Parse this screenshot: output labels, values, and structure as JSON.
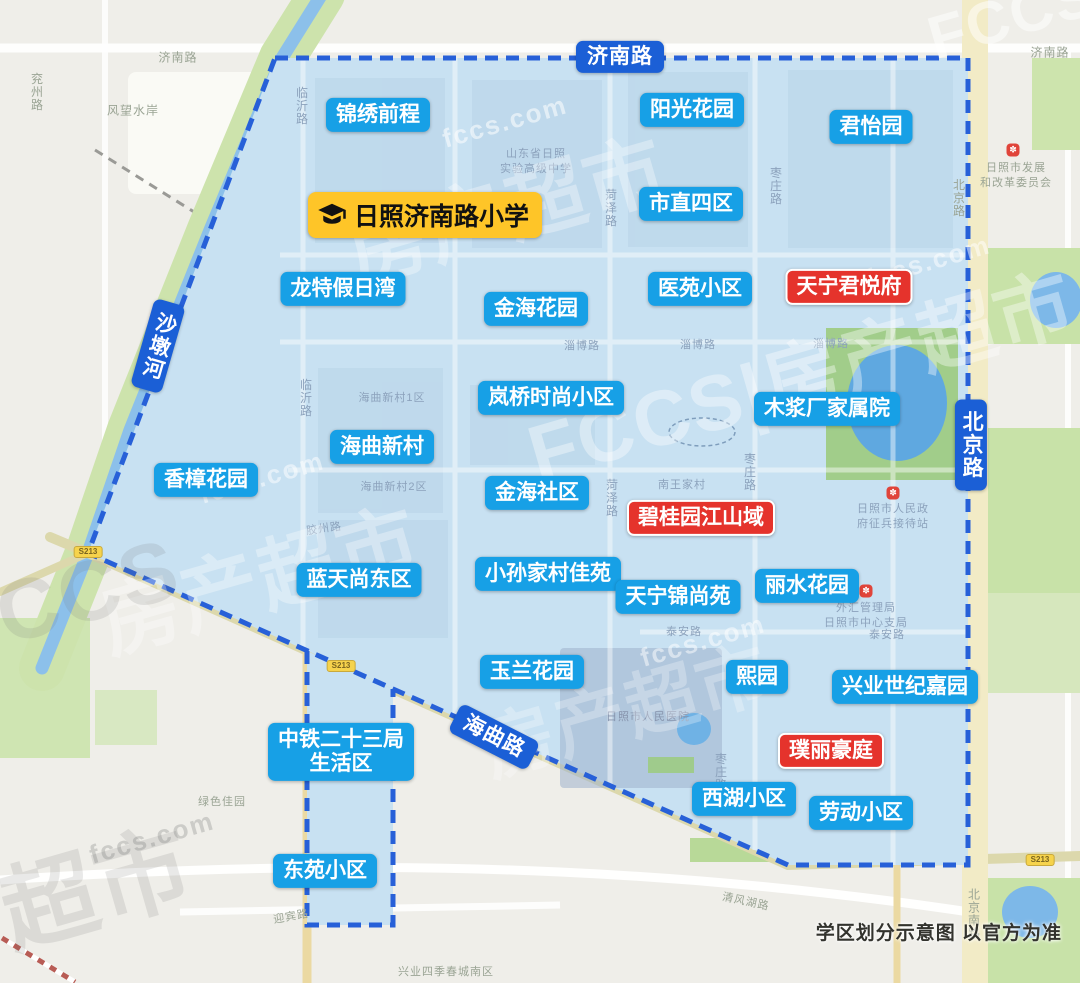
{
  "map": {
    "disclaimer": "学区划分示意图  以官方为准",
    "school": {
      "label": "日照济南路小学",
      "x": 425,
      "y": 215,
      "icon": "graduation-cap-icon"
    },
    "colors": {
      "district_fill": "#c8e1f2",
      "boundary_blue": "#2760d8",
      "community_badge_blue": "#17a0e6",
      "highlight_badge_red": "#e5332c",
      "road_badge_blue": "#1b5fd6",
      "school_badge_yellow": "#fec528",
      "map_label_gray": "#9aa494",
      "map_label_blue": "#8ca2bc",
      "map_label_dark": "#8794ad"
    },
    "road_badges": [
      {
        "label": "济南路",
        "x": 620,
        "y": 57,
        "orient": "h",
        "rot": 0
      },
      {
        "label": "北京路",
        "x": 971,
        "y": 445,
        "orient": "v",
        "rot": 0
      },
      {
        "label": "海曲路",
        "x": 494,
        "y": 737,
        "orient": "h",
        "rot": 27
      },
      {
        "label": "沙墩河",
        "x": 158,
        "y": 346,
        "orient": "v",
        "rot": 16
      }
    ],
    "communities_blue": [
      {
        "label": "锦绣前程",
        "x": 378,
        "y": 115
      },
      {
        "label": "阳光花园",
        "x": 692,
        "y": 110
      },
      {
        "label": "君怡园",
        "x": 871,
        "y": 127
      },
      {
        "label": "市直四区",
        "x": 691,
        "y": 204
      },
      {
        "label": "龙特假日湾",
        "x": 343,
        "y": 289
      },
      {
        "label": "金海花园",
        "x": 536,
        "y": 309
      },
      {
        "label": "医苑小区",
        "x": 700,
        "y": 289
      },
      {
        "label": "岚桥时尚小区",
        "x": 551,
        "y": 398
      },
      {
        "label": "木浆厂家属院",
        "x": 827,
        "y": 409
      },
      {
        "label": "海曲新村",
        "x": 382,
        "y": 447
      },
      {
        "label": "香樟花园",
        "x": 206,
        "y": 480
      },
      {
        "label": "金海社区",
        "x": 537,
        "y": 493
      },
      {
        "label": "蓝天尚东区",
        "x": 359,
        "y": 580
      },
      {
        "label": "小孙家村佳苑",
        "x": 548,
        "y": 574
      },
      {
        "label": "天宁锦尚苑",
        "x": 678,
        "y": 597
      },
      {
        "label": "丽水花园",
        "x": 807,
        "y": 586
      },
      {
        "label": "玉兰花园",
        "x": 532,
        "y": 672
      },
      {
        "label": "熙园",
        "x": 757,
        "y": 677
      },
      {
        "label": "兴业世纪嘉园",
        "x": 905,
        "y": 687
      },
      {
        "label": "中铁二十三局\n生活区",
        "x": 341,
        "y": 752
      },
      {
        "label": "西湖小区",
        "x": 744,
        "y": 799
      },
      {
        "label": "劳动小区",
        "x": 861,
        "y": 813
      },
      {
        "label": "东苑小区",
        "x": 325,
        "y": 871
      }
    ],
    "communities_red": [
      {
        "label": "天宁君悦府",
        "x": 849,
        "y": 287
      },
      {
        "label": "碧桂园江山域",
        "x": 701,
        "y": 518
      },
      {
        "label": "璞丽豪庭",
        "x": 831,
        "y": 751
      }
    ],
    "map_labels": [
      {
        "text": "济南路",
        "x": 178,
        "y": 57,
        "o": "h",
        "c": "gray"
      },
      {
        "text": "济南路",
        "x": 1050,
        "y": 52,
        "o": "h",
        "c": "gray"
      },
      {
        "text": "兖州路",
        "x": 37,
        "y": 92,
        "o": "v",
        "c": "gray"
      },
      {
        "text": "风望水岸",
        "x": 133,
        "y": 110,
        "o": "h",
        "c": "gray"
      },
      {
        "text": "临沂路",
        "x": 302,
        "y": 106,
        "o": "v",
        "c": "blue"
      },
      {
        "text": "临沂路",
        "x": 306,
        "y": 398,
        "o": "v",
        "c": "blue"
      },
      {
        "text": "菏泽路",
        "x": 611,
        "y": 208,
        "o": "v",
        "c": "blue"
      },
      {
        "text": "菏泽路",
        "x": 612,
        "y": 498,
        "o": "v",
        "c": "blue"
      },
      {
        "text": "枣庄路",
        "x": 776,
        "y": 186,
        "o": "v",
        "c": "blue"
      },
      {
        "text": "枣庄路",
        "x": 750,
        "y": 472,
        "o": "v",
        "c": "blue"
      },
      {
        "text": "枣庄路",
        "x": 721,
        "y": 772,
        "o": "v",
        "c": "blue"
      },
      {
        "text": "淄博路",
        "x": 582,
        "y": 345,
        "o": "h",
        "c": "blue",
        "small": true
      },
      {
        "text": "淄博路",
        "x": 698,
        "y": 344,
        "o": "h",
        "c": "blue",
        "small": true
      },
      {
        "text": "淄博路",
        "x": 831,
        "y": 343,
        "o": "h",
        "c": "blue",
        "small": true
      },
      {
        "text": "泰安路",
        "x": 684,
        "y": 631,
        "o": "h",
        "c": "blue",
        "small": true
      },
      {
        "text": "泰安路",
        "x": 887,
        "y": 634,
        "o": "h",
        "c": "blue",
        "small": true
      },
      {
        "text": "海曲新村1区",
        "x": 392,
        "y": 397,
        "o": "h",
        "c": "blue",
        "small": true
      },
      {
        "text": "海曲新村2区",
        "x": 394,
        "y": 486,
        "o": "h",
        "c": "blue",
        "small": true
      },
      {
        "text": "南王家村",
        "x": 682,
        "y": 484,
        "o": "h",
        "c": "blue",
        "small": true
      },
      {
        "text": "胶州路",
        "x": 324,
        "y": 528,
        "o": "h",
        "c": "blue",
        "small": true,
        "rot": -8
      },
      {
        "text": "山东省日照",
        "x": 536,
        "y": 153,
        "o": "h",
        "c": "blue",
        "small": true
      },
      {
        "text": "实验高级中学",
        "x": 536,
        "y": 168,
        "o": "h",
        "c": "blue",
        "small": true
      },
      {
        "text": "日照市发展",
        "x": 1016,
        "y": 167,
        "o": "h",
        "c": "gray",
        "small": true
      },
      {
        "text": "和改革委员会",
        "x": 1016,
        "y": 182,
        "o": "h",
        "c": "gray",
        "small": true
      },
      {
        "text": "日照市人民政",
        "x": 893,
        "y": 508,
        "o": "h",
        "c": "blue",
        "small": true
      },
      {
        "text": "府征兵接待站",
        "x": 893,
        "y": 523,
        "o": "h",
        "c": "blue",
        "small": true
      },
      {
        "text": "外汇管理局",
        "x": 866,
        "y": 607,
        "o": "h",
        "c": "blue",
        "small": true
      },
      {
        "text": "日照市中心支局",
        "x": 866,
        "y": 622,
        "o": "h",
        "c": "blue",
        "small": true
      },
      {
        "text": "日照市人民医院",
        "x": 648,
        "y": 716,
        "o": "h",
        "c": "dark",
        "small": true
      },
      {
        "text": "绿色佳园",
        "x": 222,
        "y": 801,
        "o": "h",
        "c": "gray",
        "small": true
      },
      {
        "text": "兴业四季春城南区",
        "x": 446,
        "y": 971,
        "o": "h",
        "c": "gray",
        "small": true
      },
      {
        "text": "迎宾路",
        "x": 291,
        "y": 916,
        "o": "h",
        "c": "gray",
        "small": true,
        "rot": -10
      },
      {
        "text": "清风湖路",
        "x": 746,
        "y": 901,
        "o": "h",
        "c": "gray",
        "small": true,
        "rot": 12
      },
      {
        "text": "北京南路",
        "x": 974,
        "y": 914,
        "o": "v",
        "c": "gray"
      },
      {
        "text": "北京路",
        "x": 959,
        "y": 198,
        "o": "v",
        "c": "gray"
      }
    ],
    "pois": [
      {
        "x": 1013,
        "y": 150
      },
      {
        "x": 893,
        "y": 493
      },
      {
        "x": 866,
        "y": 591
      }
    ],
    "road_shields": [
      {
        "text": "S213",
        "x": 88,
        "y": 552
      },
      {
        "text": "S213",
        "x": 341,
        "y": 666
      },
      {
        "text": "S213",
        "x": 1040,
        "y": 860
      }
    ],
    "watermarks": [
      {
        "text": "fccs.com",
        "x": 505,
        "y": 122,
        "size": 26,
        "rot": -16,
        "color": "rgba(255,255,255,0.55)"
      },
      {
        "text": "fccs.com",
        "x": 928,
        "y": 262,
        "size": 26,
        "rot": -16,
        "color": "rgba(255,255,255,0.5)"
      },
      {
        "text": "fccs.com",
        "x": 262,
        "y": 478,
        "size": 26,
        "rot": -16,
        "color": "rgba(255,255,255,0.5)"
      },
      {
        "text": "fccs.com",
        "x": 703,
        "y": 641,
        "size": 26,
        "rot": -16,
        "color": "rgba(255,255,255,0.5)"
      },
      {
        "text": "fccs.com",
        "x": 152,
        "y": 838,
        "size": 26,
        "rot": -16,
        "color": "rgba(140,140,140,0.35)"
      },
      {
        "text": "FCCS|房产超市",
        "x": 800,
        "y": 372,
        "size": 78,
        "rot": -16,
        "color": "rgba(255,255,255,0.38)"
      },
      {
        "text": "房产超市",
        "x": 505,
        "y": 205,
        "size": 80,
        "rot": -16,
        "color": "rgba(255,255,255,0.33)"
      },
      {
        "text": "房产超市",
        "x": 258,
        "y": 575,
        "size": 80,
        "rot": -16,
        "color": "rgba(255,255,255,0.33)"
      },
      {
        "text": "房产超市",
        "x": 625,
        "y": 705,
        "size": 72,
        "rot": -16,
        "color": "rgba(255,255,255,0.28)"
      },
      {
        "text": "FCCS",
        "x": 62,
        "y": 600,
        "size": 85,
        "rot": -16,
        "color": "rgba(120,120,120,0.16)"
      },
      {
        "text": "超市",
        "x": 95,
        "y": 882,
        "size": 95,
        "rot": -16,
        "color": "rgba(110,110,110,0.15)"
      },
      {
        "text": "FCCS",
        "x": 1012,
        "y": 16,
        "size": 60,
        "rot": -16,
        "color": "rgba(255,255,255,0.5)"
      }
    ]
  }
}
